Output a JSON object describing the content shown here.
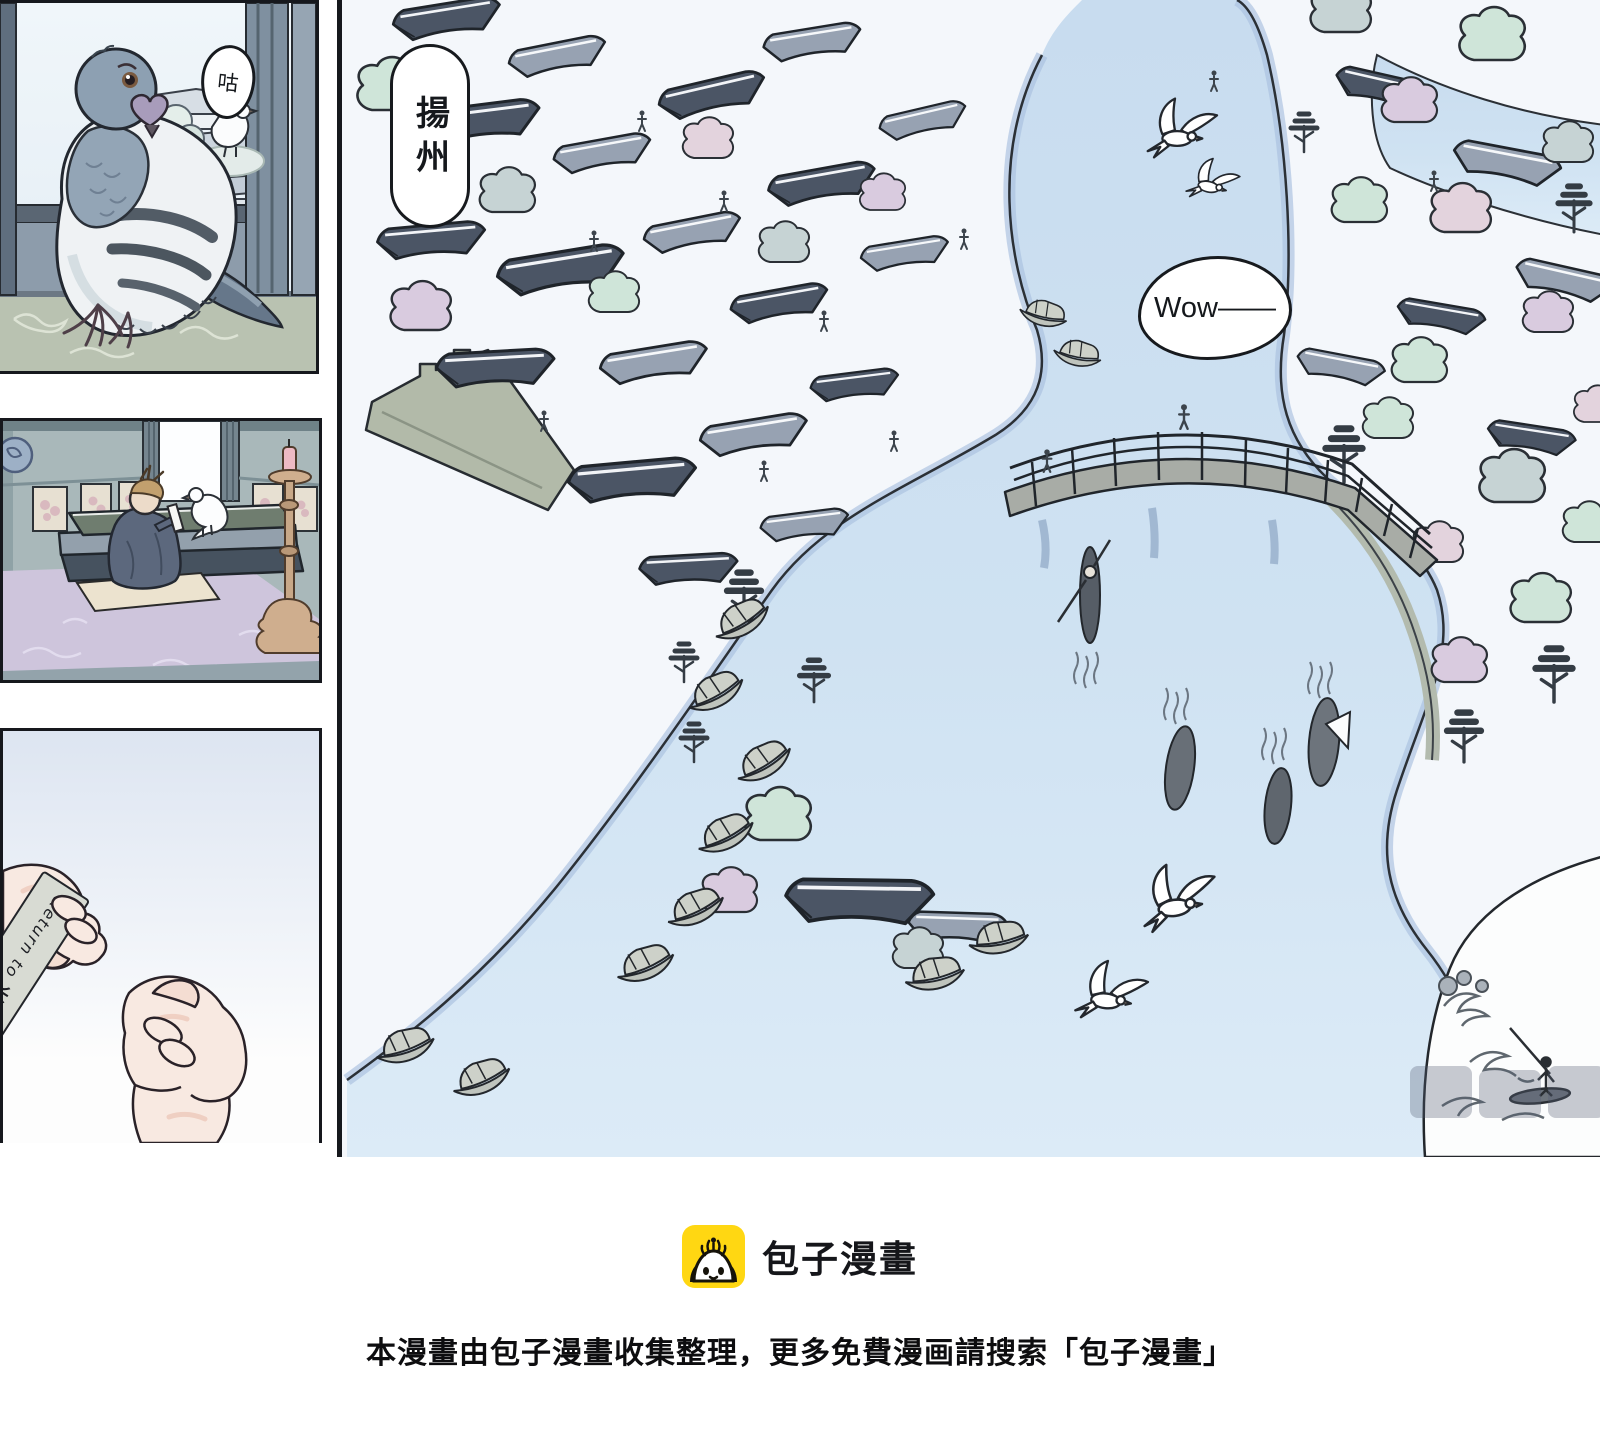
{
  "comic": {
    "panel_pigeon": {
      "bubble": "咕"
    },
    "panel_city": {
      "place_label": "揚州",
      "bubble": "Wow——"
    },
    "panel_note": {
      "en_start": "Return to",
      "cn": "长安",
      "en_end": "soon."
    }
  },
  "footer": {
    "brand": "包子漫畫",
    "notice": "本漫畫由包子漫畫收集整理，更多免費漫画請搜索「包子漫畫」"
  },
  "colors": {
    "brand_yellow": "#ffd712",
    "water_blue": "#cfe2f2",
    "ink_outline": "#1c2025",
    "tree_mint": "#cfe5d9",
    "tree_lavender": "#d9cbdf",
    "carpet_lavender": "#cec5dc"
  }
}
